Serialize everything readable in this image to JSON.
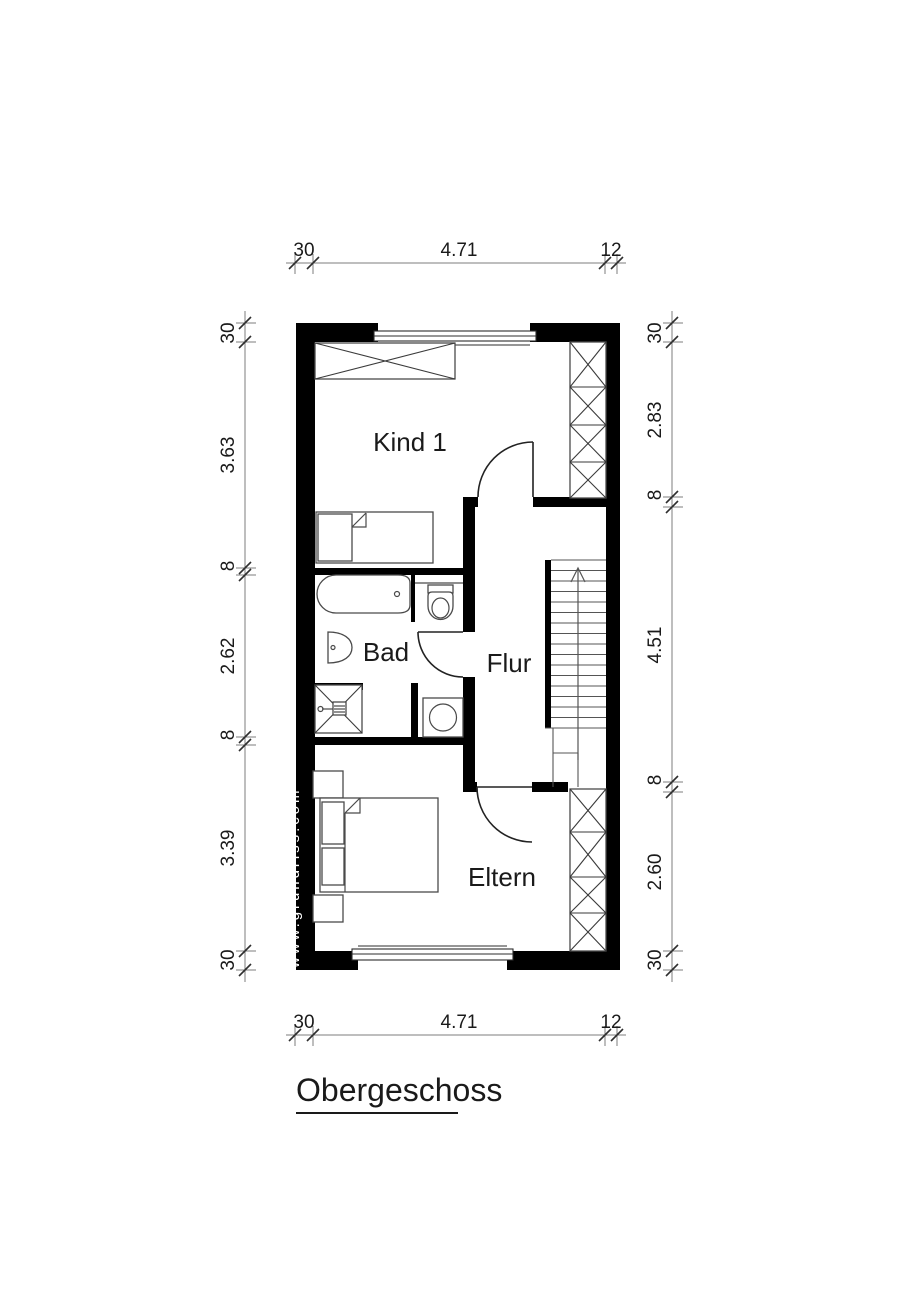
{
  "title": "Obergeschoss",
  "watermark": "www.grundriss.com",
  "floor_plan": {
    "rooms": [
      {
        "name": "Kind 1"
      },
      {
        "name": "Bad"
      },
      {
        "name": "Flur"
      },
      {
        "name": "Eltern"
      }
    ],
    "dimensions_m": {
      "top": [
        "30",
        "4.71",
        "12"
      ],
      "bottom": [
        "30",
        "4.71",
        "12"
      ],
      "left": [
        "30",
        "3.63",
        "8",
        "2.62",
        "8",
        "3.39",
        "30"
      ],
      "right": [
        "30",
        "2.83",
        "8",
        "4.51",
        "8",
        "2.60",
        "30"
      ]
    }
  },
  "colors": {
    "walls": "#000000",
    "furniture_line": "#4a4a4a",
    "dimension_line": "#7d7d7d",
    "text": "#1a1a1a",
    "background": "#ffffff"
  }
}
